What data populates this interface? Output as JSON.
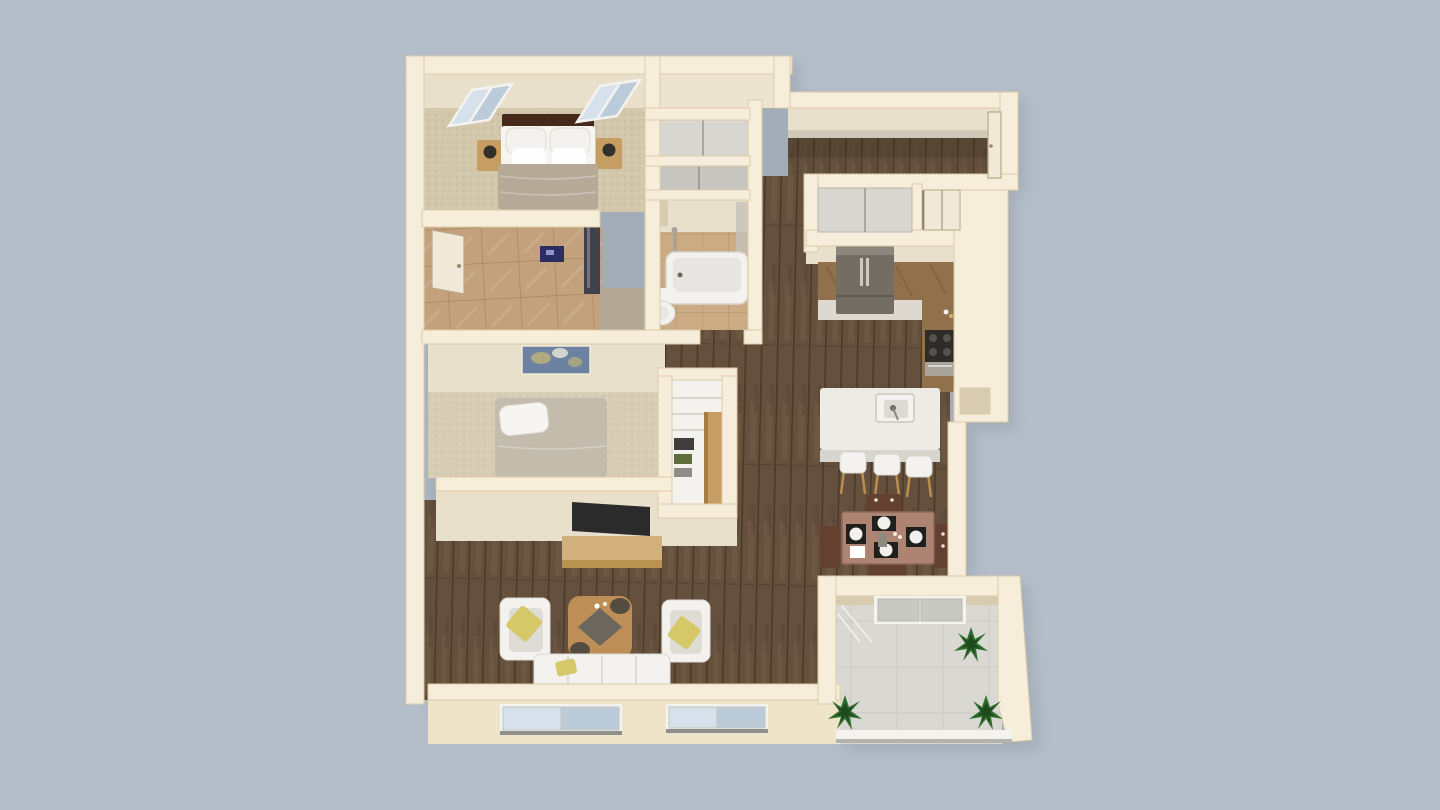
{
  "scene": {
    "name": "apartment-3d-floor-plan",
    "background": "#b4bec8",
    "shadow": "#8b95a2"
  },
  "colors": {
    "wallTop": "#f6edda",
    "wallEdge": "#ddcba8",
    "wallFaceOuter": "#efe3c9",
    "roomFace": "#e9e0cc",
    "roomFaceDark": "#d9cbb0",
    "carpetMaster": "#d2c6ab",
    "carpetGuest": "#d7cdb4",
    "tileDressing": "#c2a17c",
    "tileBath": "#cbab83",
    "floorGapGray": "#b3a996",
    "utilityFloor": "#ece3d0",
    "woodBase": "#64503c",
    "woodDark": "#4b392a",
    "woodLight": "#7a644d",
    "balconyFloor": "#d9d8d3",
    "concreteLine": "#c3c2bd",
    "white": "#f3f2ee",
    "whiteShade": "#deDCd4",
    "cushionYellow": "#d5c868",
    "rugTan": "#bd8e55",
    "rugGray": "#6b675f",
    "rugDark": "#554c40",
    "tableWood": "#ad8472",
    "chairWood": "#63402f",
    "placemat": "#1f1f1d",
    "plate": "#f1f0ec",
    "islandWhite": "#ecebe6",
    "islandFace": "#d7d5cd",
    "counterWood": "#91714b",
    "counterFace": "#ddd9d0",
    "fridge": "#746d64",
    "fridgeHi": "#8d867c",
    "steel": "#a8a49c",
    "steelDark": "#6e6a63",
    "burner": "#2e2c29",
    "blanketMaster": "#b5aa97",
    "blanketGuest": "#c3bbac",
    "pillowWhite": "#f6f5f1",
    "headboard": "#46291b",
    "nightstand": "#c69d62",
    "lampDark": "#332f2c",
    "glassBlue": "#d6e1ec",
    "glassBlueDark": "#bccbda",
    "glassGray": "#c9c9c4",
    "frameWhite": "#f4f3ef",
    "plantGreen": "#2f6d2d",
    "plantDark": "#1e4a1e",
    "artBlue": "#6d82a0",
    "artOlive": "#b8ad7e",
    "artNavy": "#2c2d62",
    "mirrorDark": "#41414b",
    "doorCream": "#f0e9d8",
    "doorSeam": "#b9a888",
    "tvDark": "#2b2b2b",
    "consoleWood": "#d2b07c",
    "consoleShade": "#b8934f",
    "closetPanel": "#d8d6d0",
    "closetPanelDark": "#c7c5bf",
    "stoolLeg": "#b98e4e",
    "clothesDark": "#3f3e3c",
    "clothesGreen": "#5d6e3c",
    "clothesGray": "#8d8c88",
    "sillDark": "#90908c",
    "tubInner": "#e7e6e2"
  },
  "rooms": {
    "master_bedroom": {
      "id": "master-bedroom",
      "furniture": [
        "double-bed",
        "headboard",
        "pillows",
        "nightstand-left",
        "nightstand-right",
        "lamps",
        "slanted-window-left",
        "slanted-window-right"
      ]
    },
    "master_dressing": {
      "id": "master-dressing-area",
      "furniture": [
        "door-leaf",
        "navy-wall-art",
        "mirror-panel",
        "tile-floor"
      ]
    },
    "utility_room": {
      "id": "utility-room",
      "furniture": []
    },
    "hall_closets": {
      "id": "hall-closets",
      "furniture": [
        "sliding-closet-upper",
        "sliding-closet-lower"
      ]
    },
    "bathroom": {
      "id": "bathroom",
      "furniture": [
        "bathtub",
        "toilet",
        "shower-fixture"
      ]
    },
    "entry_hall": {
      "id": "entry-hall",
      "furniture": [
        "entry-door"
      ]
    },
    "entry_closets": {
      "id": "entry-closets",
      "furniture": [
        "sliding-door-closet",
        "storage-closet-door"
      ]
    },
    "kitchen": {
      "id": "kitchen",
      "furniture": [
        "refrigerator",
        "l-shaped-counter",
        "range",
        "island-with-sink",
        "bar-stool",
        "bar-stool",
        "bar-stool",
        "wall-niche"
      ]
    },
    "dining_area": {
      "id": "dining-area",
      "furniture": [
        "dining-table",
        "chair",
        "chair",
        "chair",
        "chair",
        "placemats-4",
        "plates-4",
        "napkin"
      ]
    },
    "second_bedroom": {
      "id": "second-bedroom",
      "furniture": [
        "bed",
        "abstract-wall-art",
        "closet-shelves",
        "tall-cabinet"
      ]
    },
    "living_room": {
      "id": "living-room",
      "furniture": [
        "sofa",
        "armchair-left",
        "armchair-right",
        "coffee-table-rug",
        "tv",
        "media-console",
        "window",
        "window"
      ]
    },
    "balcony": {
      "id": "balcony",
      "furniture": [
        "sliding-glass-door",
        "plant",
        "plant",
        "plant",
        "railing"
      ]
    }
  },
  "counts": {
    "plants": 3,
    "bar_stools": 3,
    "dining_chairs": 4,
    "bottom_windows": 2,
    "bedroom_windows": 2
  }
}
